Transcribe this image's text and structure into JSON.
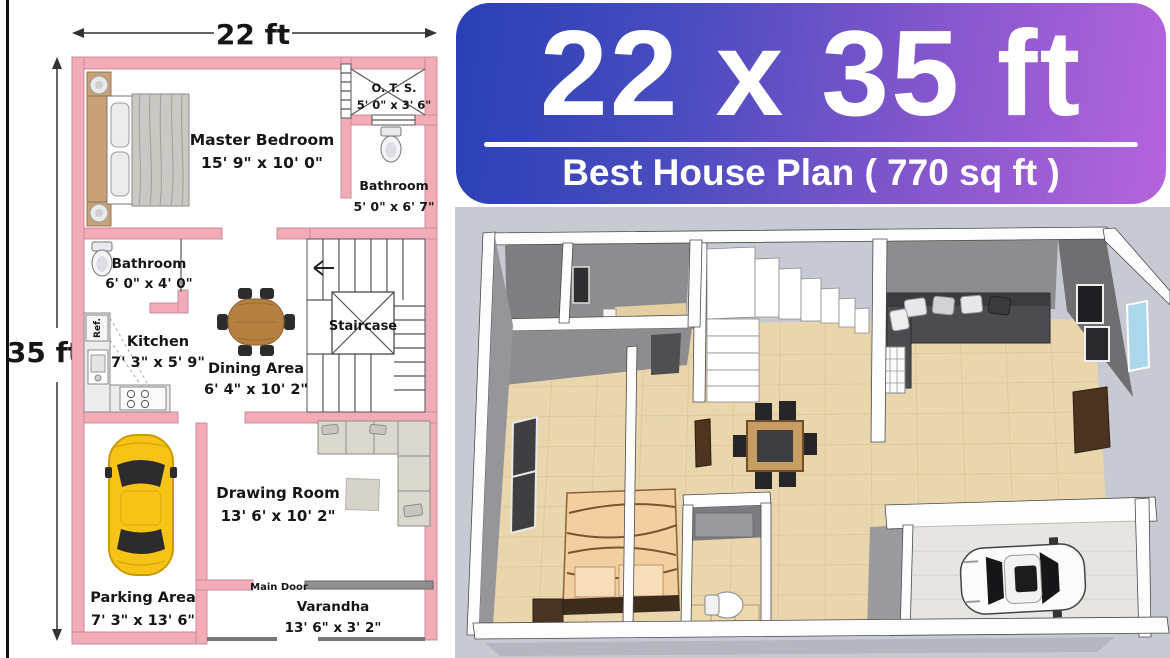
{
  "banner": {
    "title": "22 x 35 ft",
    "subtitle": "Best House Plan ( 770 sq ft )",
    "gradient_start": "#2840b4",
    "gradient_end": "#b564dd",
    "text_color": "#ffffff"
  },
  "plan": {
    "width_label": "22 ft",
    "height_label": "35 ft",
    "wall_color": "#f3abb7",
    "rooms": {
      "master_bedroom": {
        "name": "Master Bedroom",
        "size": "15' 9\" x 10' 0\""
      },
      "ots": {
        "name": "O. T. S.",
        "size": "5' 0\" x 3' 6\""
      },
      "bathroom_top": {
        "name": "Bathroom",
        "size": "5' 0\" x 6' 7\""
      },
      "bathroom_mid": {
        "name": "Bathroom",
        "size": "6' 0\" x 4' 0\""
      },
      "kitchen": {
        "name": "Kitchen",
        "size": "7' 3\" x 5' 9\""
      },
      "dining": {
        "name": "Dining Area",
        "size": "6' 4\" x 10' 2\""
      },
      "staircase": {
        "name": "Staircase"
      },
      "drawing": {
        "name": "Drawing Room",
        "size": "13' 6' x 10' 2\""
      },
      "parking": {
        "name": "Parking Area",
        "size": "7' 3\" x 13' 6\""
      },
      "varandha": {
        "name": "Varandha",
        "size": "13' 6\" x 3' 2\""
      }
    },
    "labels": {
      "main_door": "Main Door",
      "fridge": "Ref."
    }
  },
  "view3d": {
    "background": "#c8cad3",
    "floor_color": "#e9d6ac",
    "wall_top_color": "#fdfdfd",
    "wall_face_color": "#8d8d90"
  }
}
